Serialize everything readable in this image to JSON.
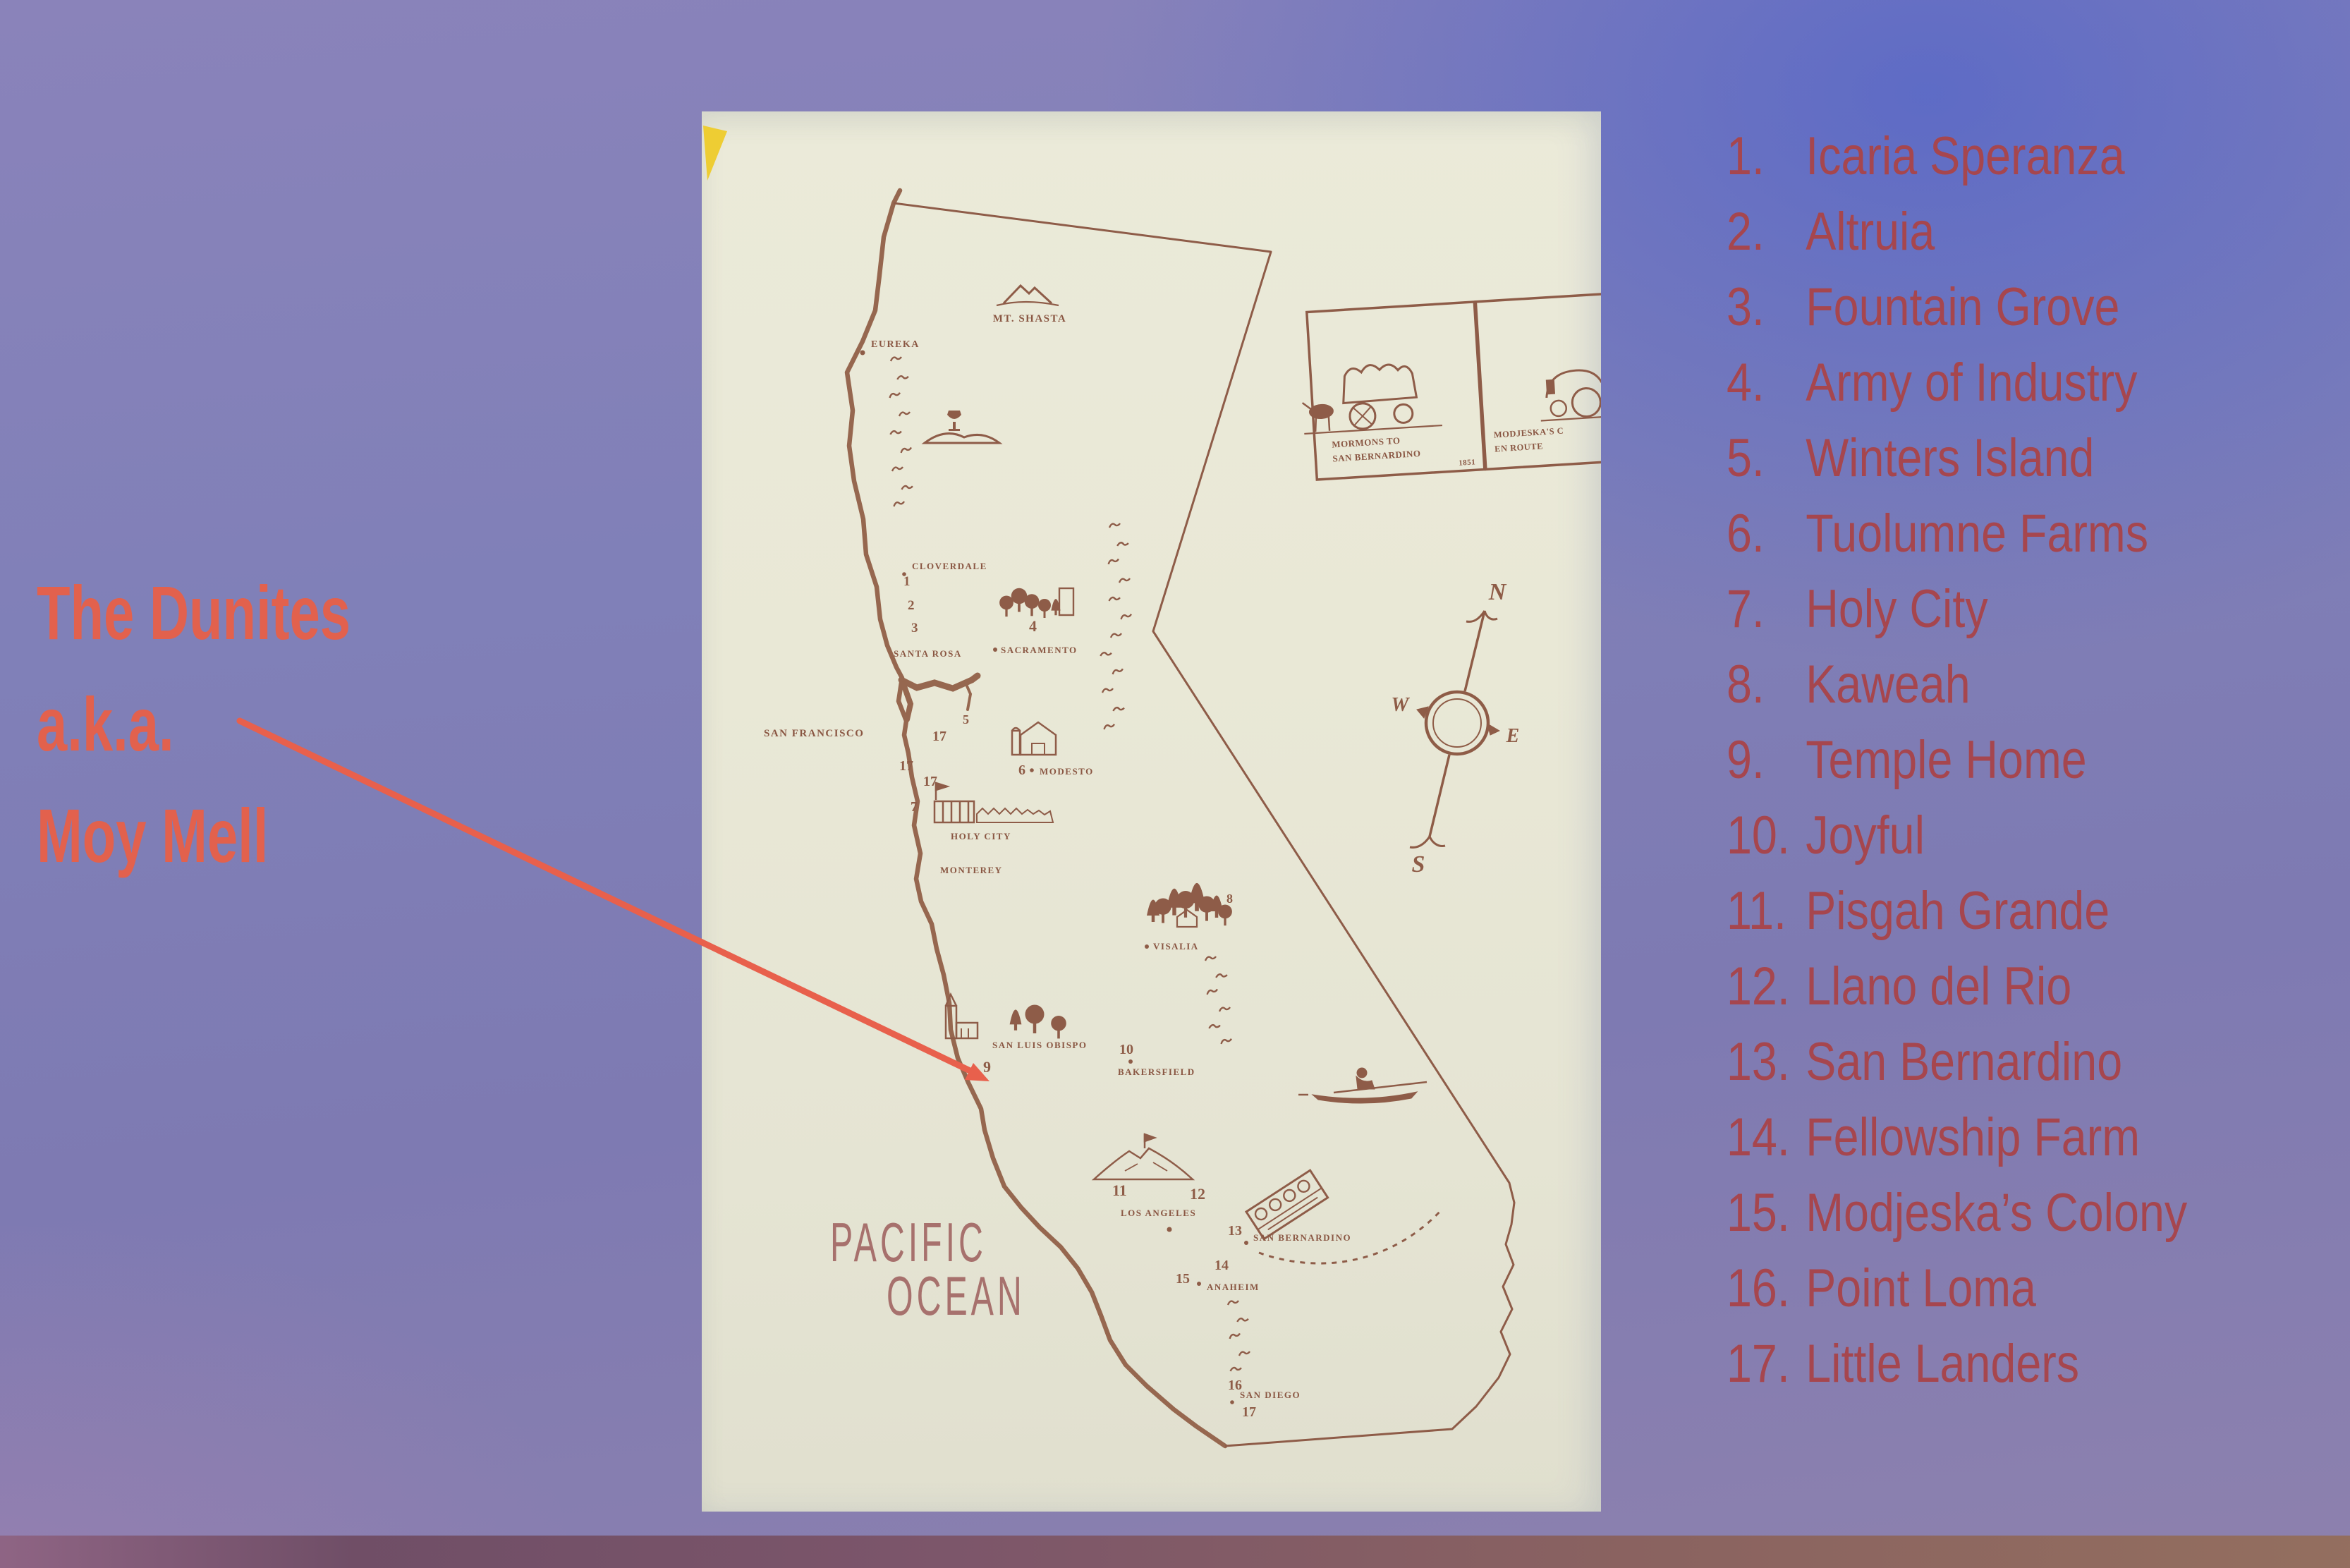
{
  "colors": {
    "annotation_red": "#e2614d",
    "arrow_red": "#e8604c",
    "list_text": "#a6464e",
    "map_ink": "#8e5c47",
    "page_paper": "#e9e8d6",
    "slide_purple": "#8080b8",
    "slide_blue": "#5b69bd",
    "corner_mark_yellow": "#eecb2a"
  },
  "annotation": {
    "line1": "The Dunites",
    "line2": "a.k.a.",
    "line3": "Moy Mell"
  },
  "colonies": [
    {
      "num": "1.",
      "name": "Icaria Speranza"
    },
    {
      "num": "2.",
      "name": "Altruia"
    },
    {
      "num": "3.",
      "name": "Fountain Grove"
    },
    {
      "num": "4.",
      "name": "Army of Industry"
    },
    {
      "num": "5.",
      "name": "Winters Island"
    },
    {
      "num": "6.",
      "name": "Tuolumne Farms"
    },
    {
      "num": "7.",
      "name": "Holy City"
    },
    {
      "num": "8.",
      "name": "Kaweah"
    },
    {
      "num": "9.",
      "name": "Temple Home"
    },
    {
      "num": "10.",
      "name": "Joyful"
    },
    {
      "num": "11.",
      "name": "Pisgah Grande"
    },
    {
      "num": "12.",
      "name": "Llano del Rio"
    },
    {
      "num": "13.",
      "name": "San Bernardino"
    },
    {
      "num": "14.",
      "name": "Fellowship Farm"
    },
    {
      "num": "15.",
      "name": "Modjeska’s Colony"
    },
    {
      "num": "16.",
      "name": "Point Loma"
    },
    {
      "num": "17.",
      "name": "Little Landers"
    }
  ],
  "map": {
    "labels": {
      "mt_shasta": "MT. SHASTA",
      "eureka": "EUREKA",
      "cloverdale": "CLOVERDALE",
      "santa_rosa": "SANTA ROSA",
      "sacramento": "SACRAMENTO",
      "san_francisco": "SAN FRANCISCO",
      "modesto": "MODESTO",
      "holy_city": "HOLY CITY",
      "monterey": "MONTEREY",
      "visalia": "VISALIA",
      "san_luis_obispo": "SAN LUIS OBISPO",
      "bakersfield": "BAKERSFIELD",
      "los_angeles": "LOS ANGELES",
      "san_bernardino": "SAN BERNARDINO",
      "anaheim": "ANAHEIM",
      "san_diego": "SAN DIEGO"
    },
    "ocean": {
      "line1": "PACIFIC",
      "line2": "OCEAN"
    },
    "numbers": {
      "n1": "1",
      "n2": "2",
      "n3": "3",
      "n4": "4",
      "n5": "5",
      "n6": "6",
      "n7": "7",
      "n8": "8",
      "n9": "9",
      "n10": "10",
      "n11": "11",
      "n12": "12",
      "n13": "13",
      "n14": "14",
      "n15": "15",
      "n16": "16",
      "n17": "17"
    },
    "inset": {
      "left_line1": "MORMONS TO",
      "left_line2": "SAN BERNARDINO",
      "left_year": "1851",
      "right_line1": "MODJESKA'S C",
      "right_line2": "EN ROUTE"
    },
    "compass": {
      "n": "N",
      "e": "E",
      "s": "S",
      "w": "W"
    }
  }
}
